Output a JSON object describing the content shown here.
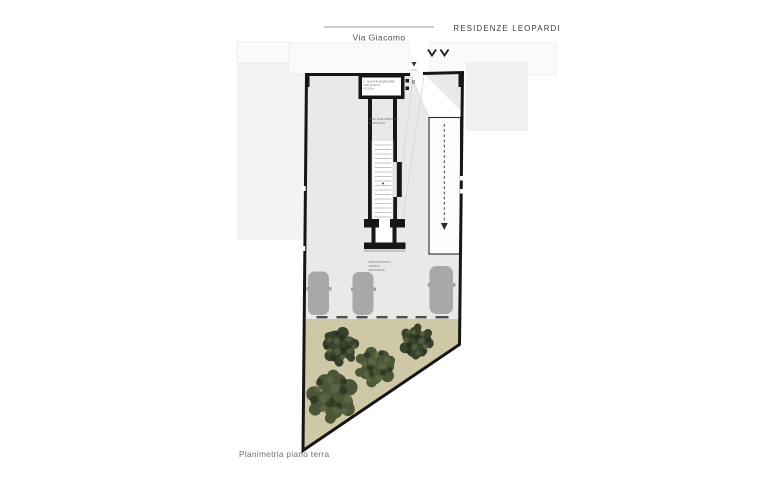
{
  "header": {
    "project_title": "RESIDENZE LEOPARDI",
    "street_name": "Via Giacomo"
  },
  "caption": "Planimetria piano terra",
  "plan": {
    "stair_block_label": [
      "C. SCALA E ASCENSORE",
      "SUP. 12,40 m²",
      "H 3,00 m"
    ],
    "stair_note": [
      "VANO SCALA RISALITA",
      "QUOTA ±0,00"
    ],
    "parking_note": [
      "SUP. POSTI AUTO",
      "125,00 m²",
      "QUOTA ±0,00"
    ],
    "entrance_level": "±0,00"
  },
  "icons": {
    "entrance_chevrons": "∨∨",
    "entrance_point": "▼",
    "ramp_direction": "↓ (dashed arrow)"
  },
  "colors": {
    "floor": "#e9e9e7",
    "garden": "#cfc8a6",
    "tree_dark": "#39422c",
    "tree_mid": "#4a5637",
    "tree_light": "#69754b",
    "tree_shadow": "#20261a",
    "car": "#a8a8a8",
    "wall": "#161616"
  }
}
